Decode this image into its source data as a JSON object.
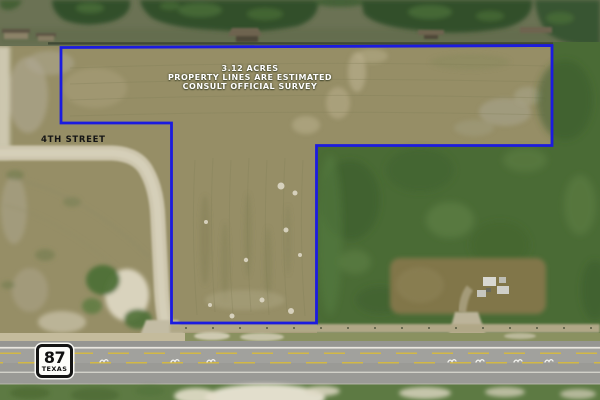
{
  "annotation": {
    "line1": "3.12 ACRES",
    "line2": "PROPERTY LINES ARE ESTIMATED",
    "line3": "CONSULT OFFICIAL SURVEY"
  },
  "street_label": "4TH STREET",
  "highway_sign": {
    "number": "87",
    "state": "TEXAS"
  },
  "property": {
    "acres": "3.12",
    "boundary_points": "61,47.5 552,45.5 552,145.5 316.5,145.5 316.5,323 171.5,323 171.5,123 61,123",
    "boundary_color": "#1b1be0"
  },
  "colors": {
    "boundary_blue": "#1b1be0",
    "annotation_text": "#ffffff",
    "street_label_text": "#151515",
    "water": "#6b7254",
    "cleared_field": "#968e66",
    "vegetation": "#4a6b35",
    "highway_asphalt": "#a1a19d",
    "dirt_road": "#cdc6ae",
    "center_line_yellow": "#d2b845",
    "sand": "#e9e4d4"
  }
}
